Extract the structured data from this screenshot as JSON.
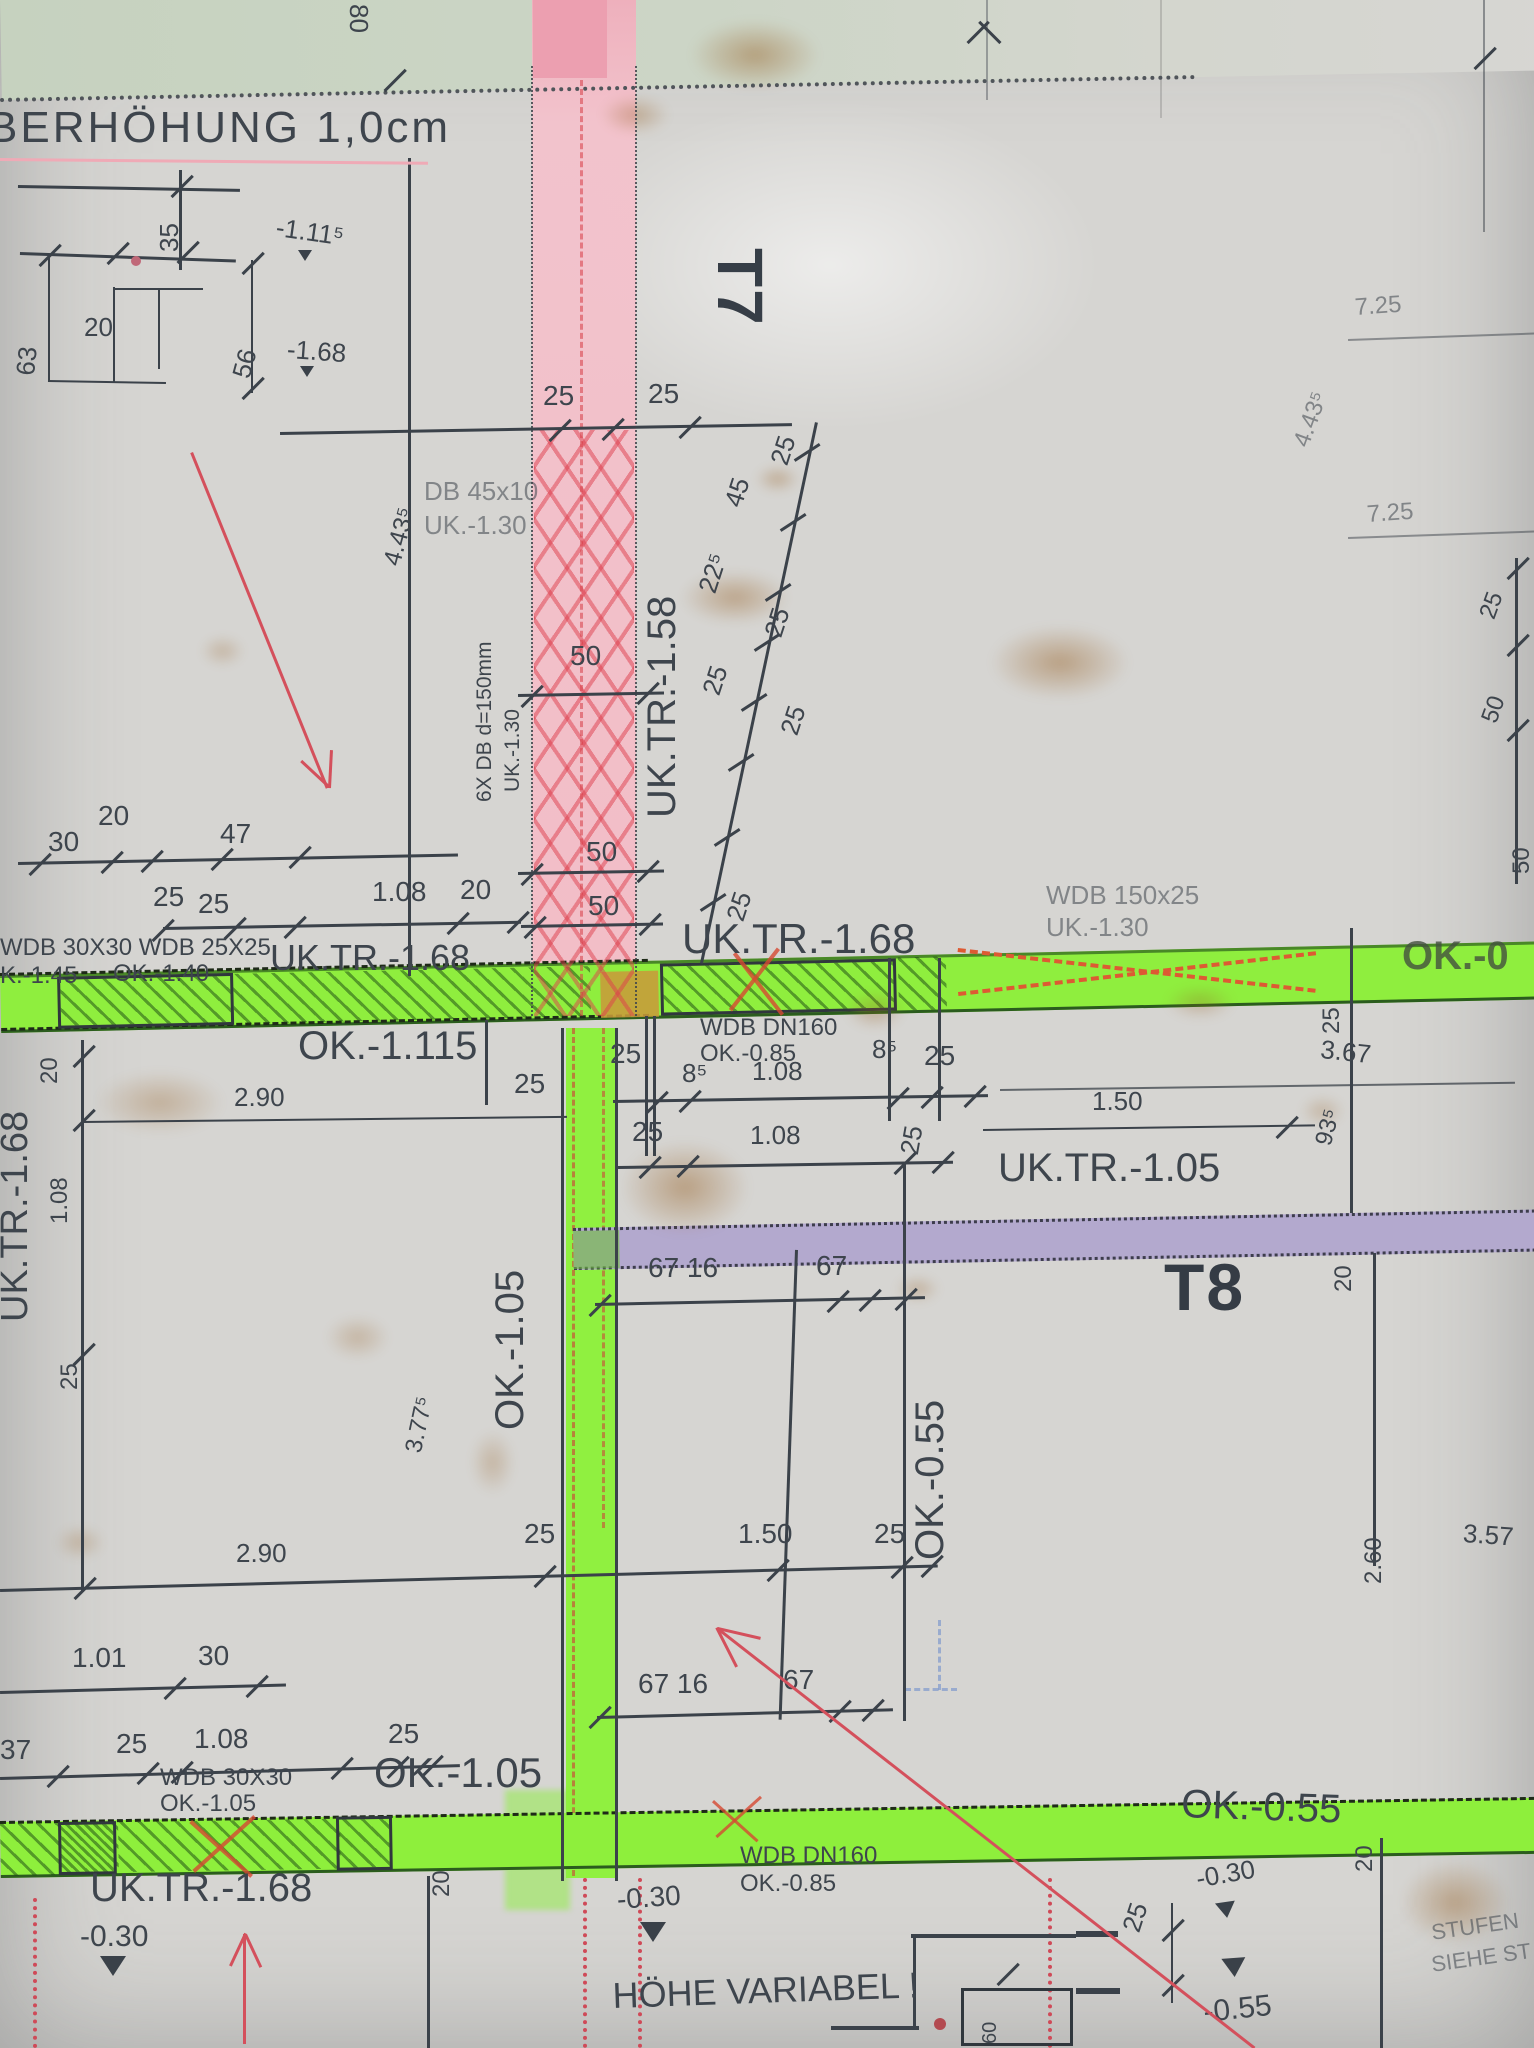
{
  "document_type": "construction-plan-photo",
  "colors": {
    "paper": "#d6d5d2",
    "ink": "#3e454d",
    "highlighter_green": "#8fee3e",
    "highlighter_pink": "#f3bcc6",
    "band_purple": "#b3a9ce",
    "red_marker": "#d4505c",
    "orange_marker": "#d6742f",
    "stamp_ink": "#28303a",
    "dark_green_border": "#2b5c1e"
  },
  "stamps": {
    "t7": "T7",
    "t8": "T8"
  },
  "labels": {
    "t80": "80",
    "ueber": "BERHÖHUNG 1,0cm",
    "d35": "35",
    "d63": "63",
    "d20a": "20",
    "d56": "56",
    "m111": "-1.11⁵",
    "m168a": "-1.68",
    "d25a": "25",
    "d25b": "25",
    "db45": "DB 45x10",
    "uk130a": "UK.-1.30",
    "d443a": "4.43⁵",
    "t7": "T7",
    "db6x": "6X DB d=150mm",
    "uk130b": "UK.-1.30",
    "uktr158": "UK.TR.-1.58",
    "d225": "22⁵",
    "d45": "45",
    "d25g": "25",
    "d25c": "25",
    "d25d": "25",
    "d25e": "25",
    "d25f": "25",
    "d50a": "50",
    "d50b": "50",
    "d50c": "50",
    "d30a": "30",
    "d20b": "20",
    "d47": "47",
    "d25h": "25",
    "d25i": "25",
    "d108a": "1.08",
    "d20c": "20",
    "wdb3030a": "WDB 30X30 WDB 25X25",
    "k145": "K.-1.45",
    "ok140": "OK.-1.40",
    "uktr168a": "UK.TR.-1.68",
    "uktr168b": "UK.TR.-1.68",
    "wdb150": "WDB 150x25",
    "uk130c": "UK.-1.30",
    "ok0r": "OK.-0",
    "ok1115": "OK.-1.115",
    "d25j": "25",
    "d25k": "25",
    "wdbdn160a": "WDB DN160",
    "ok085a": "OK.-0.85",
    "d108b": "1.08",
    "d85a": "8⁵",
    "d85b": "8⁵",
    "d25l": "25",
    "d25m": "25",
    "d108c": "1.08",
    "d25n": "25",
    "d150a": "1.50",
    "d367a": "3.67",
    "d25o": "25",
    "d935": "93⁵",
    "uktr105": "UK.TR.-1.05",
    "d290a": "2.90",
    "uktr168c": "UK.TR.-1.68",
    "d20d": "20",
    "d108d": "1.08",
    "d25q": "25",
    "d6716a": "67 16",
    "d67a": "67",
    "ok105v": "OK.-1.05",
    "t8": "T8",
    "d20e": "20",
    "ok055v": "OK.-0.55",
    "d377": "3.77⁵",
    "d290b": "2.90",
    "d25r": "25",
    "d150b": "1.50",
    "d25s": "25",
    "d101": "1.01",
    "d30b": "30",
    "d37": "37",
    "d25t": "25",
    "d108e": "1.08",
    "d25u": "25",
    "wdb3030b": "WDB 30X30",
    "ok105b": "OK.-1.05",
    "ok105big": "OK.-1.05",
    "d6716b": "67 16",
    "d67b": "67",
    "ok055big": "OK.-0.55",
    "d20f": "20",
    "uktr168d": "UK.TR.-1.68",
    "m030a": "-0.30",
    "wdbdn160b": "WDB DN160",
    "ok085b": "OK.-0.85",
    "m030b": "-0.30",
    "hoehe": "HÖHE VARIABEL !",
    "d25v": "25",
    "m030c": "-0.30",
    "m055": "-0.55",
    "d20g": "20",
    "stufen": "STUFEN",
    "siehe": "SIEHE ST",
    "d725a": "7.25",
    "d443b": "4.43⁵",
    "d725b": "7.25",
    "d25w": "25",
    "d50d": "50",
    "d50e": "50",
    "d260": "2.60",
    "d357": "3.57",
    "d60step": "60"
  }
}
